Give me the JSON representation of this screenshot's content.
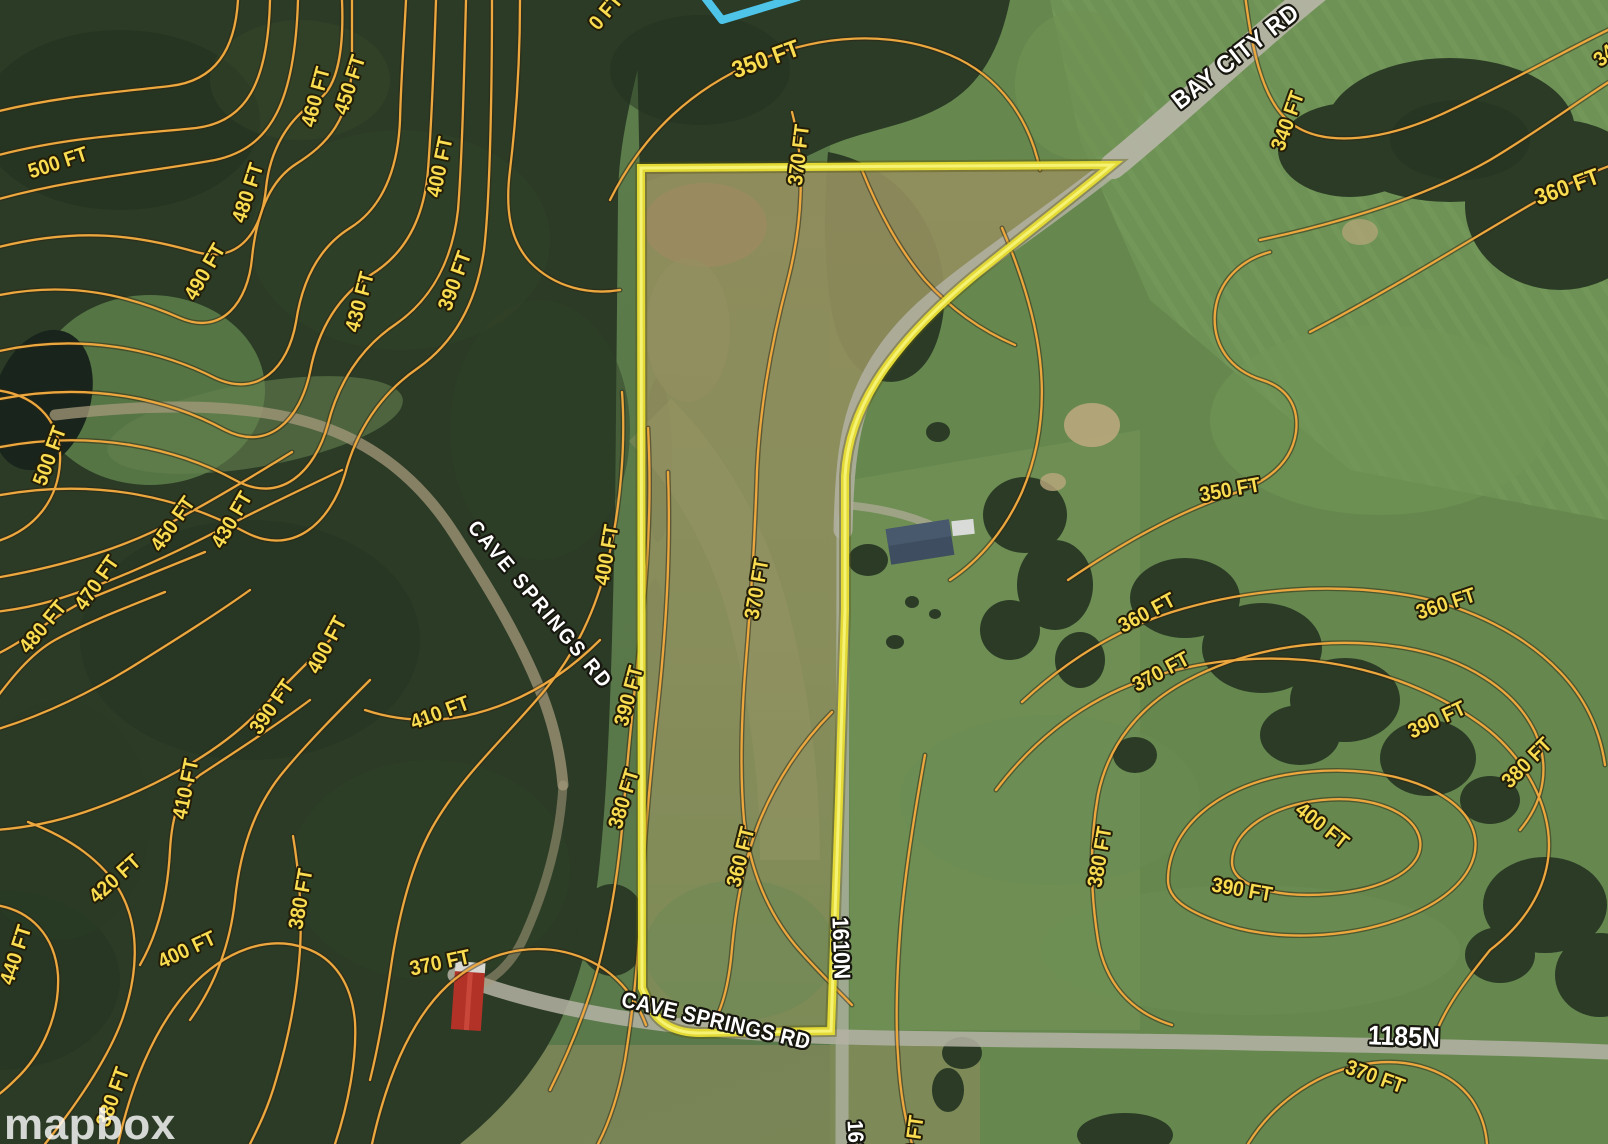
{
  "map": {
    "watermark": "mapbox",
    "colors": {
      "contour_line": "#ECA83E",
      "contour_label": "#F9DC4F",
      "parcel_boundary": "#E8DF3A",
      "road_label": "#FFFFFF",
      "stream": "#4FC4E9"
    },
    "labels": [
      {
        "text": "500 FT",
        "x": 58,
        "y": 163,
        "rot": -18,
        "kind": "contour"
      },
      {
        "text": "490 FT",
        "x": 205,
        "y": 272,
        "rot": -60,
        "kind": "contour"
      },
      {
        "text": "480 FT",
        "x": 248,
        "y": 193,
        "rot": -72,
        "kind": "contour"
      },
      {
        "text": "460 FT",
        "x": 316,
        "y": 97,
        "rot": -75,
        "kind": "contour"
      },
      {
        "text": "450 FT",
        "x": 350,
        "y": 85,
        "rot": -72,
        "kind": "contour"
      },
      {
        "text": "400 FT",
        "x": 440,
        "y": 167,
        "rot": -78,
        "kind": "contour"
      },
      {
        "text": "430 FT",
        "x": 360,
        "y": 302,
        "rot": -75,
        "kind": "contour"
      },
      {
        "text": "390 FT",
        "x": 455,
        "y": 281,
        "rot": -70,
        "kind": "contour"
      },
      {
        "text": "0 FT",
        "x": 606,
        "y": 12,
        "rot": -50,
        "kind": "contour"
      },
      {
        "text": "350 FT",
        "x": 766,
        "y": 60,
        "rot": -20,
        "size": 24,
        "kind": "contour"
      },
      {
        "text": "370 FT",
        "x": 799,
        "y": 155,
        "rot": -83,
        "kind": "contour"
      },
      {
        "text": "340 FT",
        "x": 1288,
        "y": 121,
        "rot": -70,
        "kind": "contour"
      },
      {
        "text": "340 FT",
        "x": 1620,
        "y": 43,
        "rot": -40,
        "kind": "contour"
      },
      {
        "text": "360 FT",
        "x": 1567,
        "y": 187,
        "rot": -20,
        "size": 23,
        "kind": "contour"
      },
      {
        "text": "500 FT",
        "x": 50,
        "y": 456,
        "rot": -70,
        "kind": "contour"
      },
      {
        "text": "450 FT",
        "x": 173,
        "y": 524,
        "rot": -55,
        "kind": "contour"
      },
      {
        "text": "430 FT",
        "x": 232,
        "y": 520,
        "rot": -60,
        "kind": "contour"
      },
      {
        "text": "470 FT",
        "x": 97,
        "y": 583,
        "rot": -55,
        "kind": "contour"
      },
      {
        "text": "480 FT",
        "x": 43,
        "y": 627,
        "rot": -50,
        "kind": "contour"
      },
      {
        "text": "400 FT",
        "x": 327,
        "y": 645,
        "rot": -62,
        "kind": "contour"
      },
      {
        "text": "390 FT",
        "x": 272,
        "y": 707,
        "rot": -55,
        "kind": "contour"
      },
      {
        "text": "410 FT",
        "x": 440,
        "y": 713,
        "rot": -20,
        "kind": "contour"
      },
      {
        "text": "400 FT",
        "x": 607,
        "y": 555,
        "rot": -80,
        "kind": "contour"
      },
      {
        "text": "390 FT",
        "x": 629,
        "y": 696,
        "rot": -75,
        "kind": "contour"
      },
      {
        "text": "370 FT",
        "x": 757,
        "y": 589,
        "rot": -80,
        "kind": "contour"
      },
      {
        "text": "350 FT",
        "x": 1230,
        "y": 490,
        "rot": -10,
        "kind": "contour"
      },
      {
        "text": "360 FT",
        "x": 1147,
        "y": 613,
        "rot": -28,
        "kind": "contour"
      },
      {
        "text": "370 FT",
        "x": 1161,
        "y": 672,
        "rot": -28,
        "kind": "contour"
      },
      {
        "text": "360 FT",
        "x": 1446,
        "y": 604,
        "rot": -18,
        "kind": "contour"
      },
      {
        "text": "390 FT",
        "x": 1437,
        "y": 720,
        "rot": -25,
        "kind": "contour"
      },
      {
        "text": "380 FT",
        "x": 1527,
        "y": 763,
        "rot": -45,
        "kind": "contour"
      },
      {
        "text": "420 FT",
        "x": 115,
        "y": 879,
        "rot": -42,
        "kind": "contour"
      },
      {
        "text": "440 FT",
        "x": 16,
        "y": 955,
        "rot": -72,
        "kind": "contour"
      },
      {
        "text": "400 FT",
        "x": 187,
        "y": 950,
        "rot": -25,
        "kind": "contour"
      },
      {
        "text": "380 FT",
        "x": 301,
        "y": 899,
        "rot": -80,
        "kind": "contour"
      },
      {
        "text": "370 FT",
        "x": 440,
        "y": 963,
        "rot": -12,
        "kind": "contour"
      },
      {
        "text": "410 FT",
        "x": 186,
        "y": 789,
        "rot": -78,
        "kind": "contour"
      },
      {
        "text": "380 FT",
        "x": 113,
        "y": 1097,
        "rot": -70,
        "kind": "contour"
      },
      {
        "text": "360 FT",
        "x": 741,
        "y": 857,
        "rot": -76,
        "kind": "contour"
      },
      {
        "text": "380 FT",
        "x": 1100,
        "y": 857,
        "rot": -80,
        "kind": "contour"
      },
      {
        "text": "400 FT",
        "x": 1322,
        "y": 826,
        "rot": 38,
        "kind": "contour"
      },
      {
        "text": "390 FT",
        "x": 1242,
        "y": 890,
        "rot": 10,
        "kind": "contour"
      },
      {
        "text": "370 FT",
        "x": 1375,
        "y": 1077,
        "rot": 20,
        "kind": "contour"
      },
      {
        "text": "380 FT",
        "x": 624,
        "y": 799,
        "rot": -73,
        "kind": "contour"
      },
      {
        "text": "360 FT",
        "x": 913,
        "y": 1146,
        "rot": -82,
        "kind": "contour"
      },
      {
        "text": "BAY CITY RD",
        "x": 1236,
        "y": 57,
        "rot": -38,
        "size": 25,
        "ls": 1,
        "kind": "road"
      },
      {
        "text": "CAVE SPRINGS RD",
        "x": 540,
        "y": 605,
        "rot": 50,
        "size": 21,
        "ls": 2.5,
        "kind": "road"
      },
      {
        "text": "CAVE SPRINGS RD",
        "x": 716,
        "y": 1021,
        "rot": 13,
        "size": 22,
        "ls": 0.5,
        "kind": "road"
      },
      {
        "text": "1610N",
        "x": 841,
        "y": 948,
        "rot": 88,
        "size": 23,
        "kind": "road"
      },
      {
        "text": "1185N",
        "x": 1404,
        "y": 1037,
        "rot": 2,
        "size": 27,
        "kind": "road"
      },
      {
        "text": "1610N",
        "x": 856,
        "y": 1150,
        "rot": 87,
        "size": 22,
        "kind": "road"
      }
    ]
  }
}
